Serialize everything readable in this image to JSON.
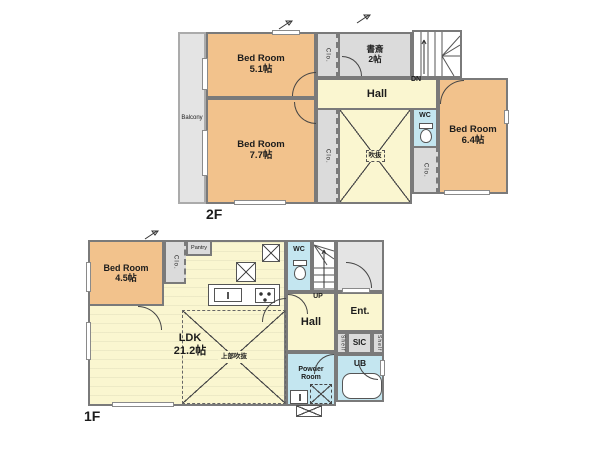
{
  "colors": {
    "bedroom_fill": "#F2C28C",
    "living_fill": "#FAF6D0",
    "water_fill": "#C4E6F0",
    "storage_fill": "#DBDBDB",
    "wall": "#7A7A7A"
  },
  "floor2": {
    "label": "2F",
    "balcony": "Balcony",
    "bedroom51": {
      "name": "Bed Room",
      "size": "5.1帖"
    },
    "bedroom77": {
      "name": "Bed Room",
      "size": "7.7帖"
    },
    "bedroom64": {
      "name": "Bed Room",
      "size": "6.4帖"
    },
    "study": {
      "name": "書斎",
      "size": "2帖"
    },
    "hall": "Hall",
    "dn": "DN",
    "wc": "WC",
    "clo": "Clo.",
    "void": "吹抜"
  },
  "floor1": {
    "label": "1F",
    "bedroom45": {
      "name": "Bed Room",
      "size": "4.5帖"
    },
    "ldk": {
      "name": "LDK",
      "size": "21.2帖"
    },
    "void_upper": "上部吹抜",
    "pantry": "Pantry",
    "clo": "Clo.",
    "wc": "WC",
    "up": "UP",
    "hall": "Hall",
    "ent": "Ent.",
    "sic": "SIC",
    "shelf": "Shelf",
    "powder_room": "Powder Room",
    "ub": "UB"
  }
}
